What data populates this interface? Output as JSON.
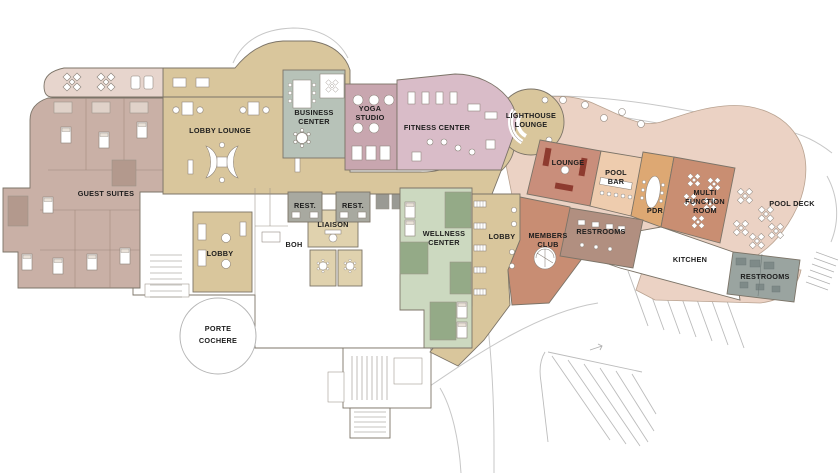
{
  "plan": {
    "title": "club resort ground floor plan",
    "rooms": {
      "guest_suites": {
        "label": "GUEST SUITES"
      },
      "lobby_lounge": {
        "label": "LOBBY LOUNGE"
      },
      "business_center": {
        "line1": "BUSINESS",
        "line2": "CENTER"
      },
      "yoga_studio": {
        "line1": "YOGA",
        "line2": "STUDIO"
      },
      "fitness_center": {
        "label": "FITNESS CENTER"
      },
      "lighthouse_lounge": {
        "line1": "LIGHTHOUSE",
        "line2": "LOUNGE"
      },
      "lounge": {
        "label": "LOUNGE"
      },
      "pool_bar": {
        "line1": "POOL",
        "line2": "BAR"
      },
      "pdr": {
        "label": "PDR"
      },
      "multi_function_room": {
        "line1": "MULTI",
        "line2": "FUNCTION",
        "line3": "ROOM"
      },
      "pool_deck": {
        "label": "POOL DECK"
      },
      "members_club": {
        "line1": "MEMBERS",
        "line2": "CLUB"
      },
      "restrooms_club_wing": {
        "label": "RESTROOMS"
      },
      "lobby_club_wing": {
        "label": "LOBBY"
      },
      "kitchen": {
        "label": "KITCHEN"
      },
      "restrooms_pool": {
        "label": "RESTROOMS"
      },
      "wellness_center": {
        "line1": "WELLNESS",
        "line2": "CENTER"
      },
      "liaison": {
        "label": "LIAISON"
      },
      "restroom_left": {
        "label": "REST."
      },
      "restroom_right": {
        "label": "REST."
      },
      "boh": {
        "label": "BOH"
      },
      "lobby_main": {
        "label": "LOBBY"
      },
      "porte_cochere": {
        "line1": "PORTE",
        "line2": "COCHERE"
      }
    },
    "colors": {
      "terrace": "#e7d5cd",
      "guest_suites": "#c9b0a6",
      "suite_light": "#e0d2c9",
      "suite_dark": "#b3998d",
      "tan": "#d9c69c",
      "tan_light": "#e0d2ae",
      "business_center": "#b7c2b8",
      "yoga": "#c8a6af",
      "fitness": "#d9bcc8",
      "wellness": "#ccd9c0",
      "wellness_dark": "#94aa87",
      "lounge": "#c98e7b",
      "pool_bar": "#eeccae",
      "pdr": "#dda873",
      "multi_function": "#c98e72",
      "members_club": "#c88d73",
      "restrooms_mauve": "#b18f80",
      "restrooms_gray": "#9aa4a0",
      "fixture_gray": "#7e8a88",
      "rest_gray": "#a8a9a0",
      "pool_deck": "#ebd2c4",
      "bench": "#ffffff",
      "sofa_dark": "#8e3b2f",
      "elevator_gray": "#9a9a94",
      "white": "#ffffff"
    }
  }
}
